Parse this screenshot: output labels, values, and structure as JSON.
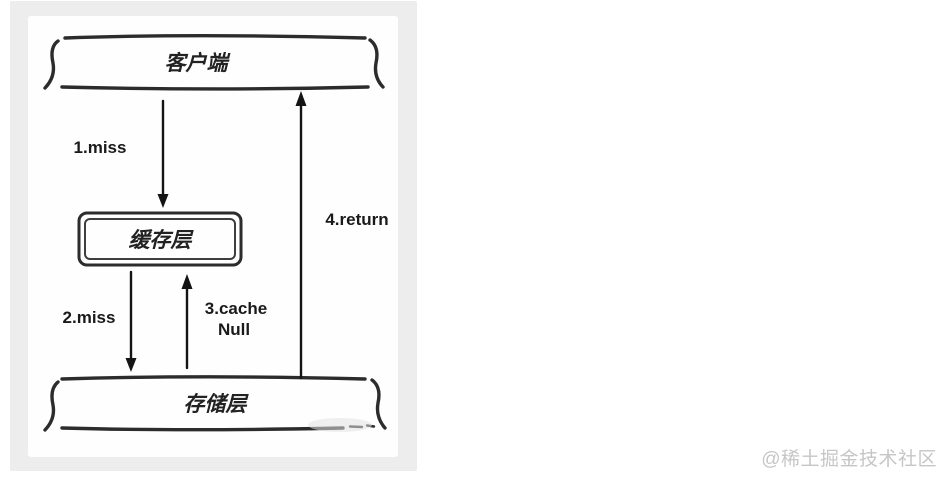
{
  "diagram": {
    "background": "#ededed",
    "panel_background": "#fefefe",
    "ink_color": "#1c1c1c",
    "nodes": {
      "client": {
        "label": "客户端"
      },
      "cache": {
        "label": "缓存层"
      },
      "storage": {
        "label": "存储层"
      }
    },
    "edges": {
      "miss1": {
        "label": "1.miss"
      },
      "miss2": {
        "label": "2.miss"
      },
      "cache_null": {
        "line1": "3.cache",
        "line2": "Null"
      },
      "return4": {
        "label": "4.return"
      }
    }
  },
  "watermark": {
    "text": "@稀土掘金技术社区",
    "color": "#c6c6c6"
  }
}
